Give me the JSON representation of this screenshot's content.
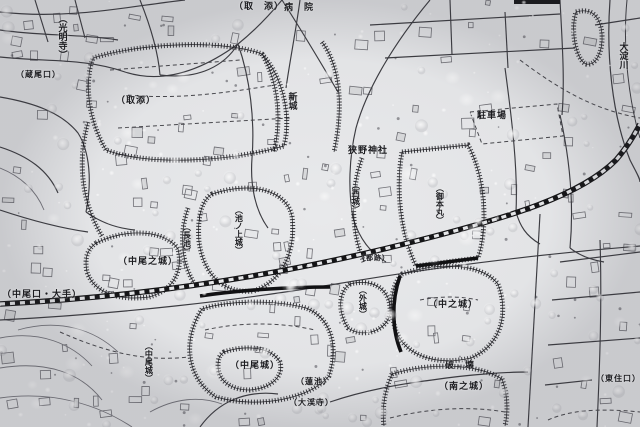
{
  "meta": {
    "kind": "photograph of a printed Japanese archaeological castle-site map covered with water droplets",
    "language": "ja"
  },
  "colors": {
    "paper": "#e8e9eb",
    "ink": "#2e2e32",
    "ink_light": "#73737a",
    "railway_black": "#141416",
    "droplet_highlight": "#ffffff",
    "label_ink": "#1b1b1f"
  },
  "map": {
    "labels": [
      {
        "id": "komyoji",
        "text": "（光明寺）",
        "x": 57,
        "y": 14,
        "v": true,
        "size": 9
      },
      {
        "id": "torizoe-top",
        "text": "（取　添）",
        "x": 234,
        "y": 2,
        "v": false,
        "size": 9
      },
      {
        "id": "hospital",
        "text": "病　院",
        "x": 284,
        "y": 3,
        "v": false,
        "size": 9
      },
      {
        "id": "kuraoguchi",
        "text": "（蔵尾口）",
        "x": 16,
        "y": 71,
        "v": false,
        "size": 8
      },
      {
        "id": "torizoe-mid",
        "text": "（取添）",
        "x": 116,
        "y": 96,
        "v": false,
        "size": 9
      },
      {
        "id": "shinjo",
        "text": "新城",
        "x": 287,
        "y": 92,
        "v": true,
        "size": 9
      },
      {
        "id": "oyodogawa",
        "text": "大淀川",
        "x": 618,
        "y": 42,
        "v": true,
        "size": 9
      },
      {
        "id": "parking",
        "text": "駐車場",
        "x": 477,
        "y": 111,
        "v": false,
        "size": 9
      },
      {
        "id": "sano-shrine",
        "text": "狭野神社",
        "x": 348,
        "y": 146,
        "v": false,
        "size": 9
      },
      {
        "id": "nishijo",
        "text": "（西城）",
        "x": 351,
        "y": 181,
        "v": true,
        "size": 8
      },
      {
        "id": "gohonmaru",
        "text": "（御本丸）",
        "x": 435,
        "y": 184,
        "v": true,
        "size": 8
      },
      {
        "id": "ikenoue-jo",
        "text": "（池ノ上城）",
        "x": 234,
        "y": 206,
        "v": true,
        "size": 8
      },
      {
        "id": "nagaike",
        "text": "（長池）",
        "x": 182,
        "y": 223,
        "v": true,
        "size": 8
      },
      {
        "id": "nakao-no-jo",
        "text": "（中尾之城）",
        "x": 118,
        "y": 257,
        "v": false,
        "size": 9
      },
      {
        "id": "miyako-ato",
        "text": "（都跡）",
        "x": 358,
        "y": 255,
        "v": false,
        "size": 7
      },
      {
        "id": "nakaoguchi-ote",
        "text": "（中尾口・大手）",
        "x": 2,
        "y": 290,
        "v": false,
        "size": 9
      },
      {
        "id": "sotojo",
        "text": "（外城）",
        "x": 358,
        "y": 286,
        "v": true,
        "size": 8
      },
      {
        "id": "nakanojo",
        "text": "（中之城）",
        "x": 428,
        "y": 300,
        "v": false,
        "size": 9
      },
      {
        "id": "nakaojo-west",
        "text": "（中尾城）",
        "x": 144,
        "y": 342,
        "v": true,
        "size": 8
      },
      {
        "id": "nakaojo-east",
        "text": "（中尾城）",
        "x": 230,
        "y": 361,
        "v": false,
        "size": 9
      },
      {
        "id": "hakai",
        "text": "破　壊",
        "x": 445,
        "y": 361,
        "v": false,
        "size": 9
      },
      {
        "id": "minami-no-jo",
        "text": "（南之城）",
        "x": 439,
        "y": 382,
        "v": false,
        "size": 9
      },
      {
        "id": "higashijuguchi",
        "text": "（東住口）",
        "x": 596,
        "y": 375,
        "v": false,
        "size": 8
      },
      {
        "id": "hasuike",
        "text": "（蓮池）",
        "x": 296,
        "y": 378,
        "v": false,
        "size": 8
      },
      {
        "id": "daikeiji",
        "text": "（大渓寺）",
        "x": 289,
        "y": 399,
        "v": false,
        "size": 8
      }
    ]
  }
}
